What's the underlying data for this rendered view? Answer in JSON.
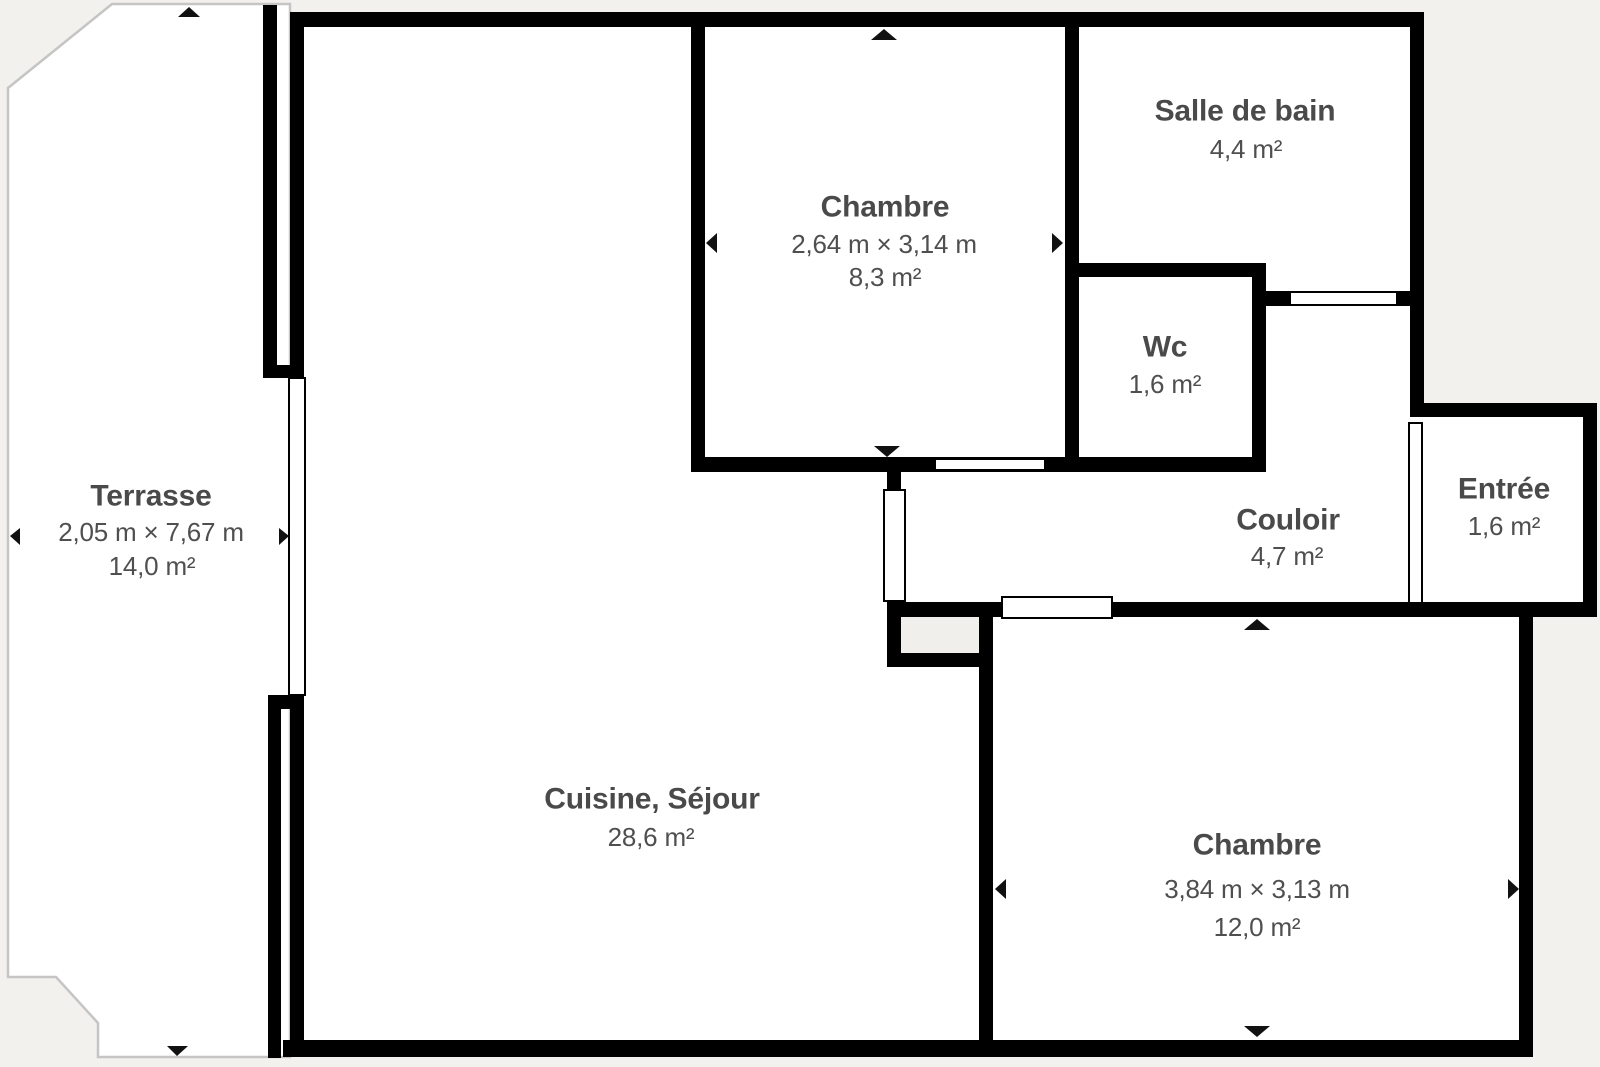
{
  "plan": {
    "type": "floor-plan",
    "colors": {
      "background": "#f2f1ee",
      "wall": "#000000",
      "room_fill": "#ffffff",
      "text": "#4a4a4a",
      "terrace_outline": "#c5c5c5",
      "shaft_fill": "#f0efec"
    },
    "rooms": [
      {
        "id": "terrasse",
        "name": "Terrasse",
        "dimensions": "2,05 m × 7,67 m",
        "area": "14,0 m²"
      },
      {
        "id": "chambre-top",
        "name": "Chambre",
        "dimensions": "2,64 m × 3,14 m",
        "area": "8,3 m²"
      },
      {
        "id": "salle-de-bain",
        "name": "Salle de bain",
        "dimensions": "",
        "area": "4,4 m²"
      },
      {
        "id": "wc",
        "name": "Wc",
        "dimensions": "",
        "area": "1,6 m²"
      },
      {
        "id": "couloir",
        "name": "Couloir",
        "dimensions": "",
        "area": "4,7 m²"
      },
      {
        "id": "entree",
        "name": "Entrée",
        "dimensions": "",
        "area": "1,6 m²"
      },
      {
        "id": "cuisine-sejour",
        "name": "Cuisine, Séjour",
        "dimensions": "",
        "area": "28,6 m²"
      },
      {
        "id": "chambre-bottom",
        "name": "Chambre",
        "dimensions": "3,84 m × 3,13 m",
        "area": "12,0 m²"
      }
    ]
  }
}
